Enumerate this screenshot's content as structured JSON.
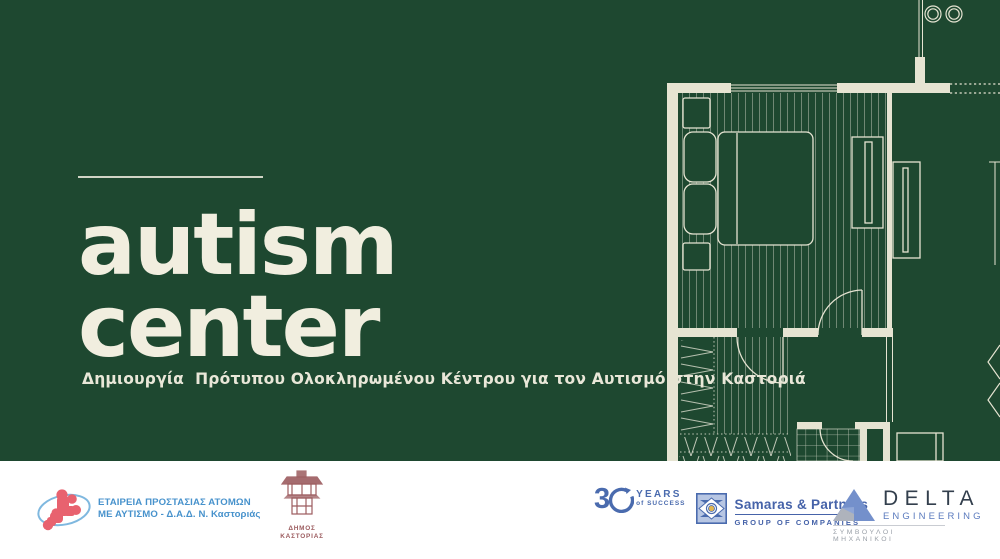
{
  "hero": {
    "title_line1": "autism",
    "title_line2": "center",
    "subtitle": "Δημιουργία  Πρότυπου Ολοκληρωμένου Κέντρου για τον Αυτισμό στην Καστοριά"
  },
  "colors": {
    "background_green": "#1E4830",
    "cream": "#E6E4D2",
    "title_cream": "#F1EEDF",
    "footer_white": "#FFFFFF",
    "autism_logo_blue": "#4792CC",
    "puzzle_pink": "#E8626F",
    "municipality_maroon": "#9C5C5F",
    "samaras_blue": "#4A6BAE",
    "delta_dark": "#333F4D",
    "delta_blue": "#5B7BBE",
    "delta_grey": "#9AA0A8"
  },
  "floor_plan": {
    "description": "Architectural floor plan of a bedroom suite drawn in cream lines on green background"
  },
  "footer": {
    "autism_society": {
      "line1": "ΕΤΑΙΡΕΙΑ ΠΡΟΣΤΑΣΙΑΣ ΑΤΟΜΩΝ",
      "line2": "ΜΕ ΑΥΤΙΣΜΟ - Δ.Α.Δ. Ν. Καστοριάς"
    },
    "municipality": {
      "line1": "ΔΗΜΟΣ",
      "line2": "ΚΑΣΤΟΡΙΑΣ"
    },
    "years30": {
      "number": "3",
      "years": "YEARS",
      "of_success": "of SUCCESS"
    },
    "samaras": {
      "name": "Samaras & Partners",
      "group": "GROUP OF COMPANIES"
    },
    "delta": {
      "name": "DELTA",
      "engineering": "ENGINEERING",
      "subtitle": "ΣΥΜΒΟΥΛΟΙ ΜΗΧΑΝΙΚΟΙ"
    }
  }
}
